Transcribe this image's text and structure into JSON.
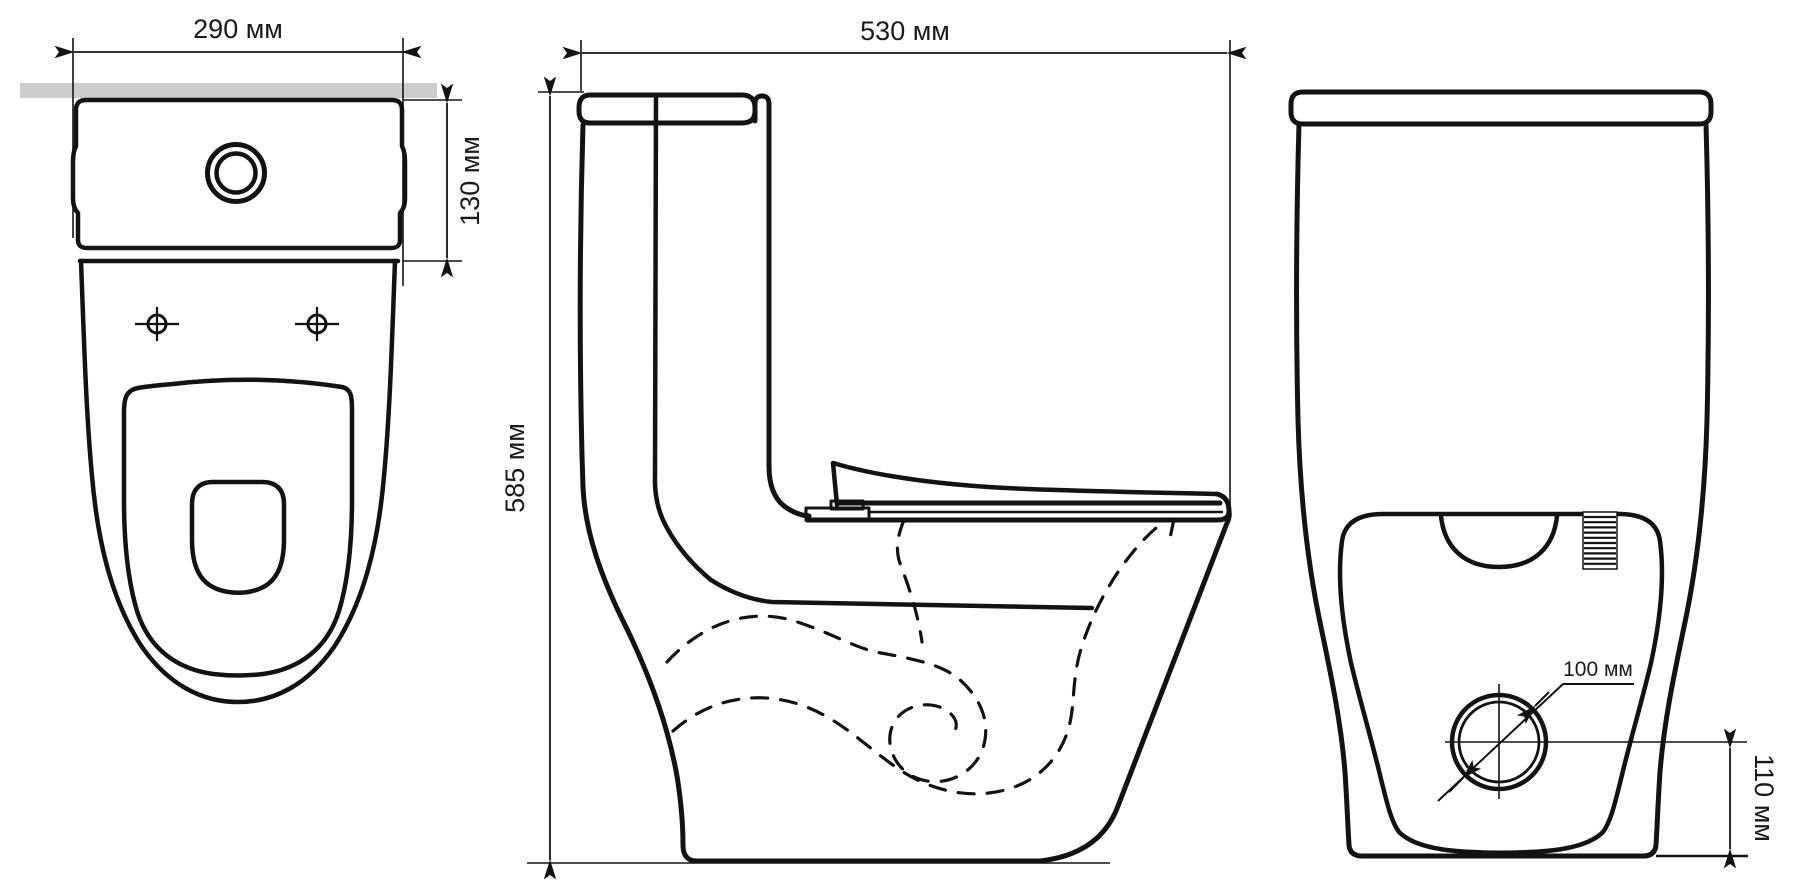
{
  "drawing": {
    "type": "technical-dimension-drawing",
    "views": [
      "top",
      "side",
      "front"
    ],
    "unit": "мм",
    "colors": {
      "line": "#131313",
      "wall_strip": "#cccccc",
      "background": "#ffffff"
    },
    "labels": {
      "top_width": "290 мм",
      "tank_height": "130 мм",
      "total_depth": "530 мм",
      "total_height": "585 мм",
      "outlet_diameter": "100 мм",
      "outlet_center_height": "110 мм"
    }
  }
}
